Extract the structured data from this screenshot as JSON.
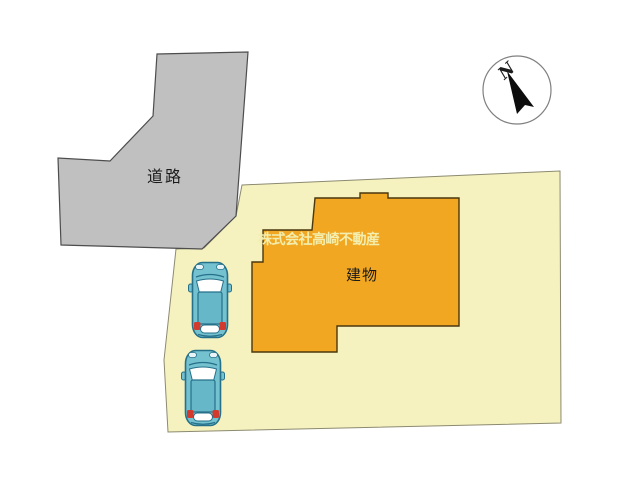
{
  "labels": {
    "road": "道路",
    "building": "建物",
    "company_watermark": "株式会社高崎不動産",
    "compass_north": "N"
  },
  "icons": {
    "compass": "north-compass-icon",
    "car": "car-top-view-icon"
  },
  "colors": {
    "background": "#FFFFFF",
    "road_fill": "#C0C0C0",
    "road_border": "#4D4D4D",
    "parcel_fill": "#F5F2BF",
    "parcel_border": "#8C8A70",
    "building_fill": "#F1A722",
    "building_border": "#4A370E",
    "car_body": "#74C1CF",
    "car_roof": "#66B7C7",
    "car_outline": "#26708A",
    "car_window": "#FFFFFF",
    "car_taillight": "#D23A2E",
    "watermark_text": "#F3EEAE",
    "label_text": "#1A1A1A",
    "compass_ring": "#808080",
    "compass_needle": "#0D0D0D"
  }
}
